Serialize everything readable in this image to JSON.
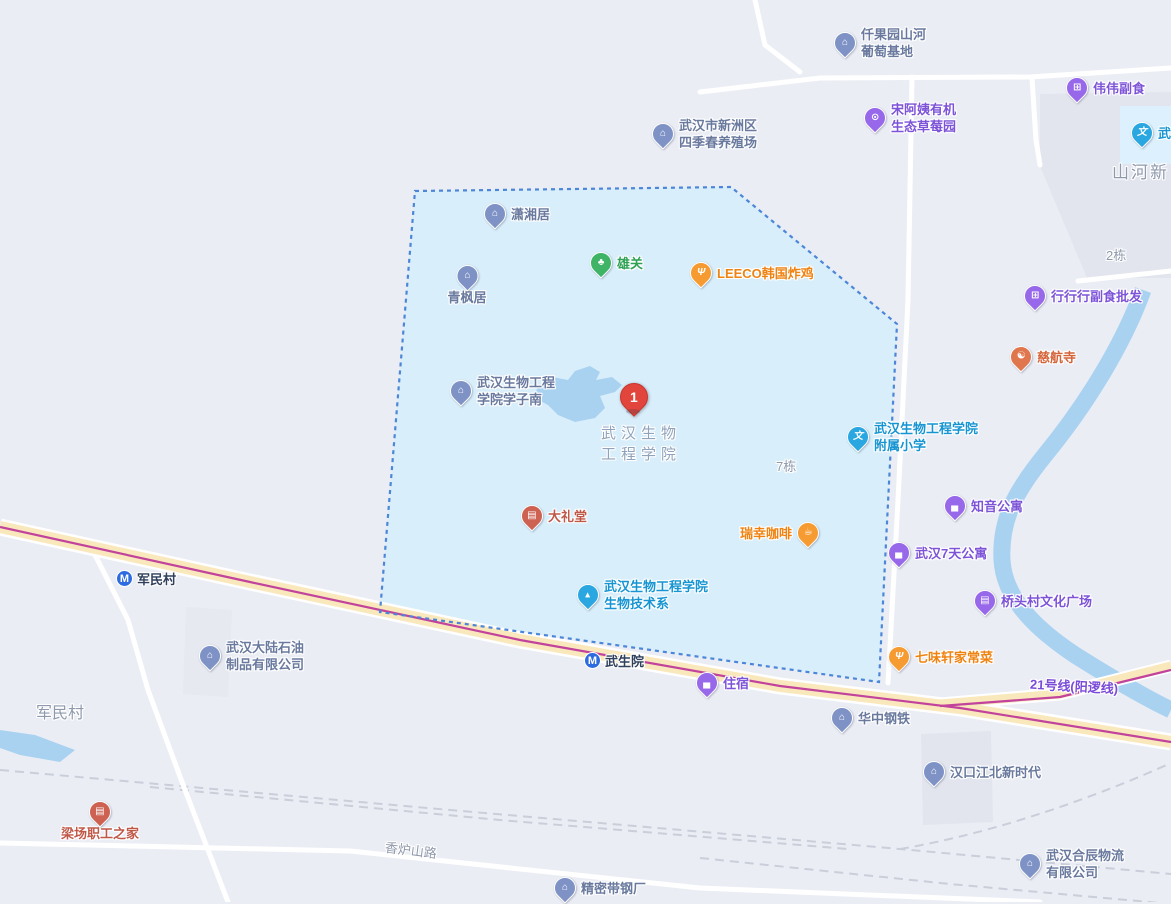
{
  "map_colors": {
    "background": "#ebedf5",
    "campus_fill": "#d8eefa",
    "campus_border": "#4c86d8",
    "water": "#a9d2f1",
    "road_fill": "#fae8bd",
    "road_casing": "#ffffff",
    "metro_line": "#c2439b",
    "railway": "#c9ced9",
    "building_block": "#e2e5ee",
    "marker_red": "#e2453c",
    "metro_icon_blue": "#2e6be0"
  },
  "categories": {
    "company": {
      "pin": "#7e92c6",
      "text": "#6a7a9e",
      "icon": "⌂",
      "icon_name": "building-icon"
    },
    "purple-shop": {
      "pin": "#9768e9",
      "text": "#7d54d8",
      "icon": "⊞",
      "icon_name": "shopping-cart-icon"
    },
    "purple-bed": {
      "pin": "#9768e9",
      "text": "#7d54d8",
      "icon": "▄",
      "icon_name": "bed-icon"
    },
    "purple-culture": {
      "pin": "#9768e9",
      "text": "#7d54d8",
      "icon": "▤",
      "icon_name": "culture-icon"
    },
    "purple-game": {
      "pin": "#9768e9",
      "text": "#7d54d8",
      "icon": "⊙",
      "icon_name": "controller-icon"
    },
    "orange-food": {
      "pin": "#f59b31",
      "text": "#ef8312",
      "icon": "Ψ",
      "icon_name": "food-icon"
    },
    "orange-coffee": {
      "pin": "#f59b31",
      "text": "#ef8312",
      "icon": "☕",
      "icon_name": "coffee-icon"
    },
    "red-theater": {
      "pin": "#cd6253",
      "text": "#c05848",
      "icon": "▤",
      "icon_name": "theater-icon"
    },
    "temple": {
      "pin": "#e0764d",
      "text": "#d4643a",
      "icon": "☯",
      "icon_name": "temple-icon"
    },
    "green-park": {
      "pin": "#3fb466",
      "text": "#2da254",
      "icon": "♣",
      "icon_name": "tree-icon"
    },
    "school": {
      "pin": "#2aa7e1",
      "text": "#1795d2",
      "icon": "文",
      "icon_name": "school-icon"
    },
    "edu-dept": {
      "pin": "#2aa7e1",
      "text": "#1795d2",
      "icon": "▴",
      "icon_name": "graduation-cap-icon"
    }
  },
  "pois": [
    {
      "label": "仟果园山河\n葡萄基地",
      "x": 845,
      "y": 37,
      "cat": "company"
    },
    {
      "label": "宋阿姨有机\n生态草莓园",
      "x": 875,
      "y": 112,
      "cat": "purple-game"
    },
    {
      "label": "伟伟副食",
      "x": 1077,
      "y": 88,
      "cat": "purple-shop"
    },
    {
      "label": "武",
      "x": 1142,
      "y": 133,
      "cat": "school"
    },
    {
      "label": "武汉市新洲区\n四季春养殖场",
      "x": 663,
      "y": 128,
      "cat": "company"
    },
    {
      "label": "潇湘居",
      "x": 495,
      "y": 214,
      "cat": "company"
    },
    {
      "label": "青枫居",
      "x": 467,
      "y": 276,
      "cat": "company",
      "layout": "below"
    },
    {
      "label": "雄关",
      "x": 601,
      "y": 263,
      "cat": "green-park"
    },
    {
      "label": "LEECO韩国炸鸡",
      "x": 701,
      "y": 273,
      "cat": "orange-food"
    },
    {
      "label": "行行行副食批发",
      "x": 1035,
      "y": 296,
      "cat": "purple-shop"
    },
    {
      "label": "慈航寺",
      "x": 1021,
      "y": 357,
      "cat": "temple"
    },
    {
      "label": "武汉生物工程\n学院学子南",
      "x": 461,
      "y": 385,
      "cat": "company"
    },
    {
      "label": "武汉生物工程学院\n附属小学",
      "x": 858,
      "y": 431,
      "cat": "school"
    },
    {
      "label": "知音公寓",
      "x": 955,
      "y": 506,
      "cat": "purple-bed"
    },
    {
      "label": "武汉7天公寓",
      "x": 899,
      "y": 553,
      "cat": "purple-bed"
    },
    {
      "label": "大礼堂",
      "x": 532,
      "y": 516,
      "cat": "red-theater"
    },
    {
      "label": "瑞幸咖啡",
      "x": 808,
      "y": 533,
      "cat": "orange-coffee",
      "layout": "left"
    },
    {
      "label": "武汉生物工程学院\n生物技术系",
      "x": 588,
      "y": 589,
      "cat": "edu-dept"
    },
    {
      "label": "桥头村文化广场",
      "x": 985,
      "y": 601,
      "cat": "purple-culture"
    },
    {
      "label": "七味轩家常菜",
      "x": 899,
      "y": 657,
      "cat": "orange-food"
    },
    {
      "label": "住宿",
      "x": 707,
      "y": 683,
      "cat": "purple-bed"
    },
    {
      "label": "华中钢铁",
      "x": 842,
      "y": 718,
      "cat": "company"
    },
    {
      "label": "武汉大陆石油\n制品有限公司",
      "x": 210,
      "y": 650,
      "cat": "company"
    },
    {
      "label": "梁场职工之家",
      "x": 100,
      "y": 812,
      "cat": "red-theater",
      "layout": "below"
    },
    {
      "label": "汉口江北新时代",
      "x": 934,
      "y": 772,
      "cat": "company"
    },
    {
      "label": "精密带钢厂",
      "x": 565,
      "y": 888,
      "cat": "company"
    },
    {
      "label": "武汉合辰物流\n有限公司",
      "x": 1030,
      "y": 858,
      "cat": "company"
    }
  ],
  "metro_stations": [
    {
      "name": "军民村",
      "x": 125,
      "y": 578
    },
    {
      "name": "武生院",
      "x": 593,
      "y": 660
    }
  ],
  "marker": {
    "number": "1",
    "x": 633,
    "y": 396
  },
  "area_labels": [
    {
      "text": "山河新",
      "x": 1112,
      "y": 162,
      "size": 17
    },
    {
      "text": "2栋",
      "x": 1106,
      "y": 245,
      "size": 13
    },
    {
      "text": "7栋",
      "x": 776,
      "y": 456,
      "size": 13
    },
    {
      "text": "军民村",
      "x": 36,
      "y": 703,
      "size": 16
    },
    {
      "text": "武汉生物\n工程学院",
      "x": 601,
      "y": 423,
      "size": 15,
      "spacing": 5
    }
  ],
  "road_labels": [
    {
      "text": "香炉山路",
      "x": 385,
      "y": 840,
      "rotate": 7
    },
    {
      "text": "21号线(阳逻线)",
      "x": 1030,
      "y": 676,
      "rotate": 3
    }
  ]
}
